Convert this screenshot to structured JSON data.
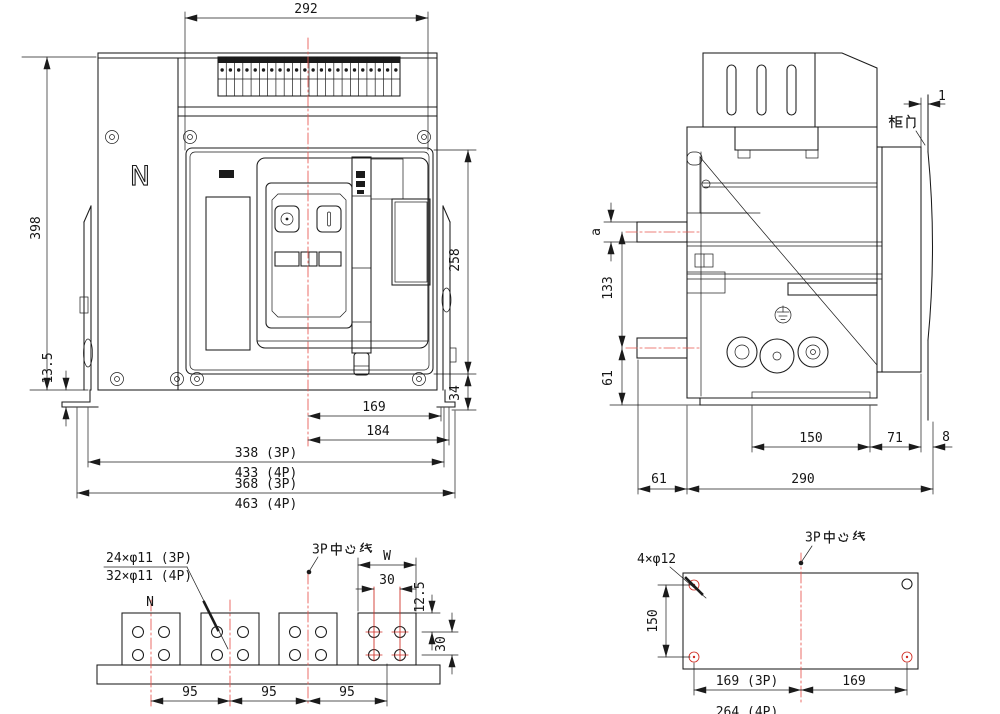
{
  "colors": {
    "line": "#1b1b1b",
    "centerline_red": "#e8554e",
    "hole_red": "#cf2a21",
    "background": "#ffffff"
  },
  "front_view": {
    "pole_label": "N",
    "dim_top_width": "292",
    "dim_height": "398",
    "dim_bracket": "13.5",
    "dim_panel_height": "258",
    "dim_foot": "34",
    "dim_center_right": "169",
    "dim_center_edge": "184",
    "dim_width_3p": "338 (3P)",
    "dim_width_4p": "433 (4P)",
    "dim_overall_3p": "368 (3P)",
    "dim_overall_4p": "463 (4P)"
  },
  "side_view": {
    "label_cabinet_door": "柜门",
    "dim_door_gap": "1",
    "dim_busbar": "a",
    "dim_busbar_pitch": "133",
    "dim_busbar_base": "61",
    "dim_mount": "150",
    "dim_front": "71",
    "dim_door_offset": "8",
    "dim_rear": "61",
    "dim_depth": "290"
  },
  "terminal_view": {
    "label_holes_3p": "24×φ11 (3P)",
    "label_holes_4p": "32×φ11 (4P)",
    "pole_label": "N",
    "label_centerline": "3P中心线",
    "dim_pad_width": "W",
    "dim_hole_h": "30",
    "dim_hole_top": "12.5",
    "dim_hole_v": "30",
    "dim_pitch_1": "95",
    "dim_pitch_2": "95",
    "dim_pitch_3": "95",
    "terminal_count": 22
  },
  "mounting_view": {
    "label_holes": "4×φ12",
    "label_centerline": "3P中心线",
    "dim_vertical": "150",
    "dim_left_3p": "169 (3P)",
    "dim_left_4p": "264 (4P)",
    "dim_right": "169"
  }
}
